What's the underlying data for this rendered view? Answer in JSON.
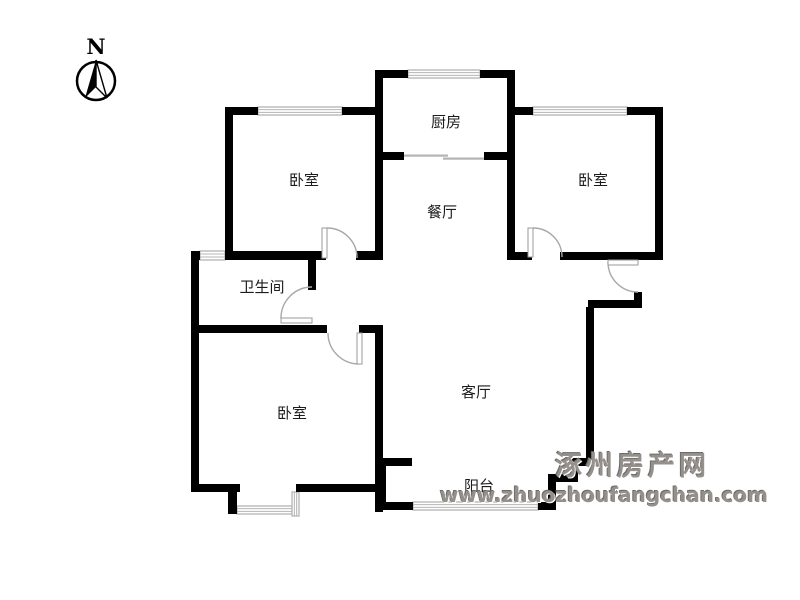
{
  "compass": {
    "label": "N"
  },
  "watermark": {
    "line1": "涿州房产网",
    "line2": "www.zhuozhoufangchan.com"
  },
  "colors": {
    "wall": "#000000",
    "window": "#b4b4b4",
    "door_leaf_stroke": "#9a9a9a",
    "door_arc": "#a8a8a8",
    "label": "#1c1c1c"
  },
  "rooms": [
    {
      "id": "kitchen",
      "label": "厨房",
      "x": 446,
      "y": 127
    },
    {
      "id": "bedroom-northwest",
      "label": "卧室",
      "x": 304,
      "y": 185
    },
    {
      "id": "bedroom-northeast",
      "label": "卧室",
      "x": 593,
      "y": 185
    },
    {
      "id": "dining-room",
      "label": "餐厅",
      "x": 442,
      "y": 217
    },
    {
      "id": "bathroom",
      "label": "卫生间",
      "x": 262,
      "y": 292
    },
    {
      "id": "bedroom-southwest",
      "label": "卧室",
      "x": 292,
      "y": 418
    },
    {
      "id": "living-room",
      "label": "客厅",
      "x": 476,
      "y": 397
    },
    {
      "id": "balcony",
      "label": "阳台",
      "x": 479,
      "y": 491
    }
  ],
  "floorplan": {
    "walls": [
      [
        375,
        70,
        33,
        8
      ],
      [
        480,
        70,
        35,
        8
      ],
      [
        375,
        70,
        8,
        190
      ],
      [
        507,
        70,
        8,
        190
      ],
      [
        225,
        107,
        33,
        8
      ],
      [
        342,
        107,
        36,
        8
      ],
      [
        225,
        107,
        8,
        151
      ],
      [
        513,
        107,
        20,
        8
      ],
      [
        627,
        107,
        36,
        8
      ],
      [
        655,
        107,
        8,
        151
      ],
      [
        375,
        152,
        29,
        8
      ],
      [
        484,
        152,
        31,
        8
      ],
      [
        191,
        251,
        9,
        9
      ],
      [
        225,
        251,
        101,
        9
      ],
      [
        356,
        251,
        27,
        9
      ],
      [
        191,
        251,
        8,
        241
      ],
      [
        308,
        252,
        8,
        38
      ],
      [
        191,
        325,
        136,
        8
      ],
      [
        359,
        325,
        24,
        8
      ],
      [
        375,
        325,
        8,
        187
      ],
      [
        507,
        252,
        25,
        8
      ],
      [
        560,
        252,
        103,
        8
      ],
      [
        634,
        292,
        8,
        16
      ],
      [
        588,
        300,
        54,
        8
      ],
      [
        586,
        307,
        8,
        156
      ],
      [
        570,
        458,
        23,
        8
      ],
      [
        570,
        458,
        8,
        24
      ],
      [
        548,
        474,
        30,
        8
      ],
      [
        548,
        474,
        8,
        36
      ],
      [
        538,
        502,
        18,
        8
      ],
      [
        378,
        502,
        35,
        8
      ],
      [
        378,
        458,
        8,
        52
      ],
      [
        376,
        458,
        36,
        8
      ],
      [
        191,
        484,
        49,
        8
      ],
      [
        296,
        484,
        82,
        8
      ],
      [
        228,
        484,
        9,
        30
      ]
    ],
    "windows": [
      {
        "x": 408,
        "y": 70,
        "w": 72,
        "h": 8,
        "o": "h"
      },
      {
        "x": 258,
        "y": 107,
        "w": 84,
        "h": 8,
        "o": "h"
      },
      {
        "x": 533,
        "y": 107,
        "w": 94,
        "h": 8,
        "o": "h"
      },
      {
        "x": 200,
        "y": 251,
        "w": 25,
        "h": 9,
        "o": "h"
      },
      {
        "x": 413,
        "y": 502,
        "w": 125,
        "h": 8,
        "o": "h"
      },
      {
        "x": 237,
        "y": 506,
        "w": 55,
        "h": 8,
        "o": "h"
      },
      {
        "x": 292,
        "y": 492,
        "w": 7,
        "h": 24,
        "o": "v"
      }
    ],
    "sliding_door_lines": [
      [
        404,
        154.5,
        44,
        2.2
      ],
      [
        443,
        157.5,
        43,
        2.2
      ]
    ],
    "doors": [
      {
        "id": "door-bedroom-northwest",
        "leaf": [
          322,
          228,
          5,
          30
        ],
        "arc": "M 327 228 A 30 30 0 0 1 357 258"
      },
      {
        "id": "door-bedroom-northeast",
        "leaf": [
          528,
          228,
          5,
          29
        ],
        "arc": "M 533 228 A 29 29 0 0 1 562 257"
      },
      {
        "id": "door-bathroom",
        "leaf": [
          281,
          318,
          31,
          5
        ],
        "arc": "M 281 318 A 31 31 0 0 1 312 287"
      },
      {
        "id": "door-bedroom-southwest",
        "leaf": [
          357,
          333,
          5,
          31
        ],
        "arc": "M 328 333 A 31 31 0 0 0 359 364"
      },
      {
        "id": "door-entry",
        "leaf": [
          608,
          260,
          30,
          5
        ],
        "arc": "M 608 262 A 30 30 0 0 0 638 292"
      }
    ]
  }
}
